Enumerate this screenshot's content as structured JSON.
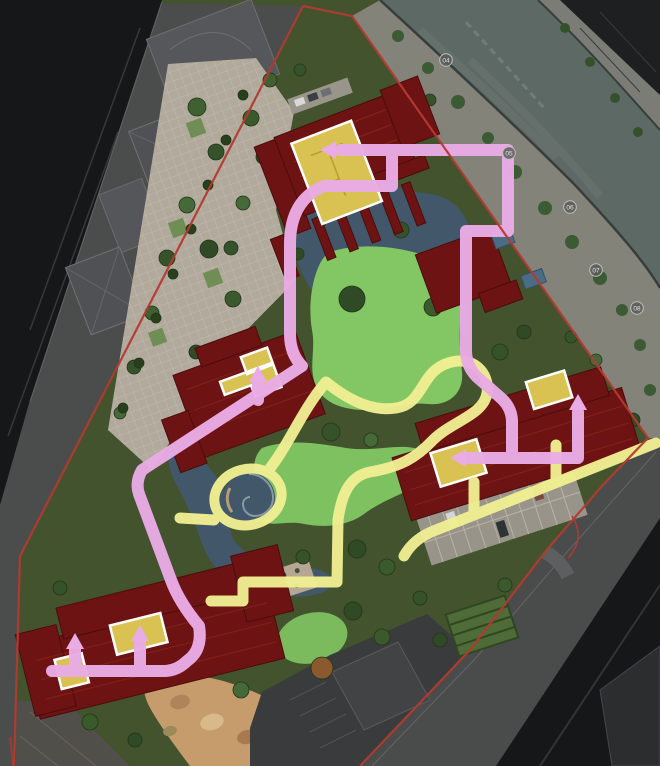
{
  "image": {
    "width": 660,
    "height": 766,
    "description": "Residential compound master plan rendering with site boundary, canal, highlighted unit roofs and two colored walking routes"
  },
  "colors": {
    "site_green": "#42532e",
    "outer_gray": "#4b4c4c",
    "asphalt_black": "#161718",
    "river_water": "#5d6965",
    "road_dark": "#4a4b4b",
    "boundary_red": "#b23a30",
    "building_maroon": "#6e1313",
    "building_edge": "#4a0c0c",
    "roof_line": "#8f2c1d",
    "unit_yellow": "#d9c251",
    "unit_border": "#ffffff",
    "route_pink": "#e9ace5",
    "route_yellow": "#f1ef92",
    "pond_blue": "#42586a",
    "lawn_green": "#82c763",
    "plaza_paving": "#b1a99b",
    "playground_tan": "#c69c6d",
    "marker_fill": "#5a5d5a",
    "marker_stroke": "#bdc0bc",
    "marker_text": "#e3e5e2"
  },
  "routes": [
    {
      "id": "pink-route",
      "color_key": "route_pink"
    },
    {
      "id": "yellow-route",
      "color_key": "route_yellow"
    }
  ],
  "river_markers": [
    {
      "label": "04",
      "x": 446,
      "y": 60
    },
    {
      "label": "05",
      "x": 509,
      "y": 153
    },
    {
      "label": "06",
      "x": 570,
      "y": 207
    },
    {
      "label": "07",
      "x": 596,
      "y": 270
    },
    {
      "label": "08",
      "x": 637,
      "y": 308
    }
  ]
}
